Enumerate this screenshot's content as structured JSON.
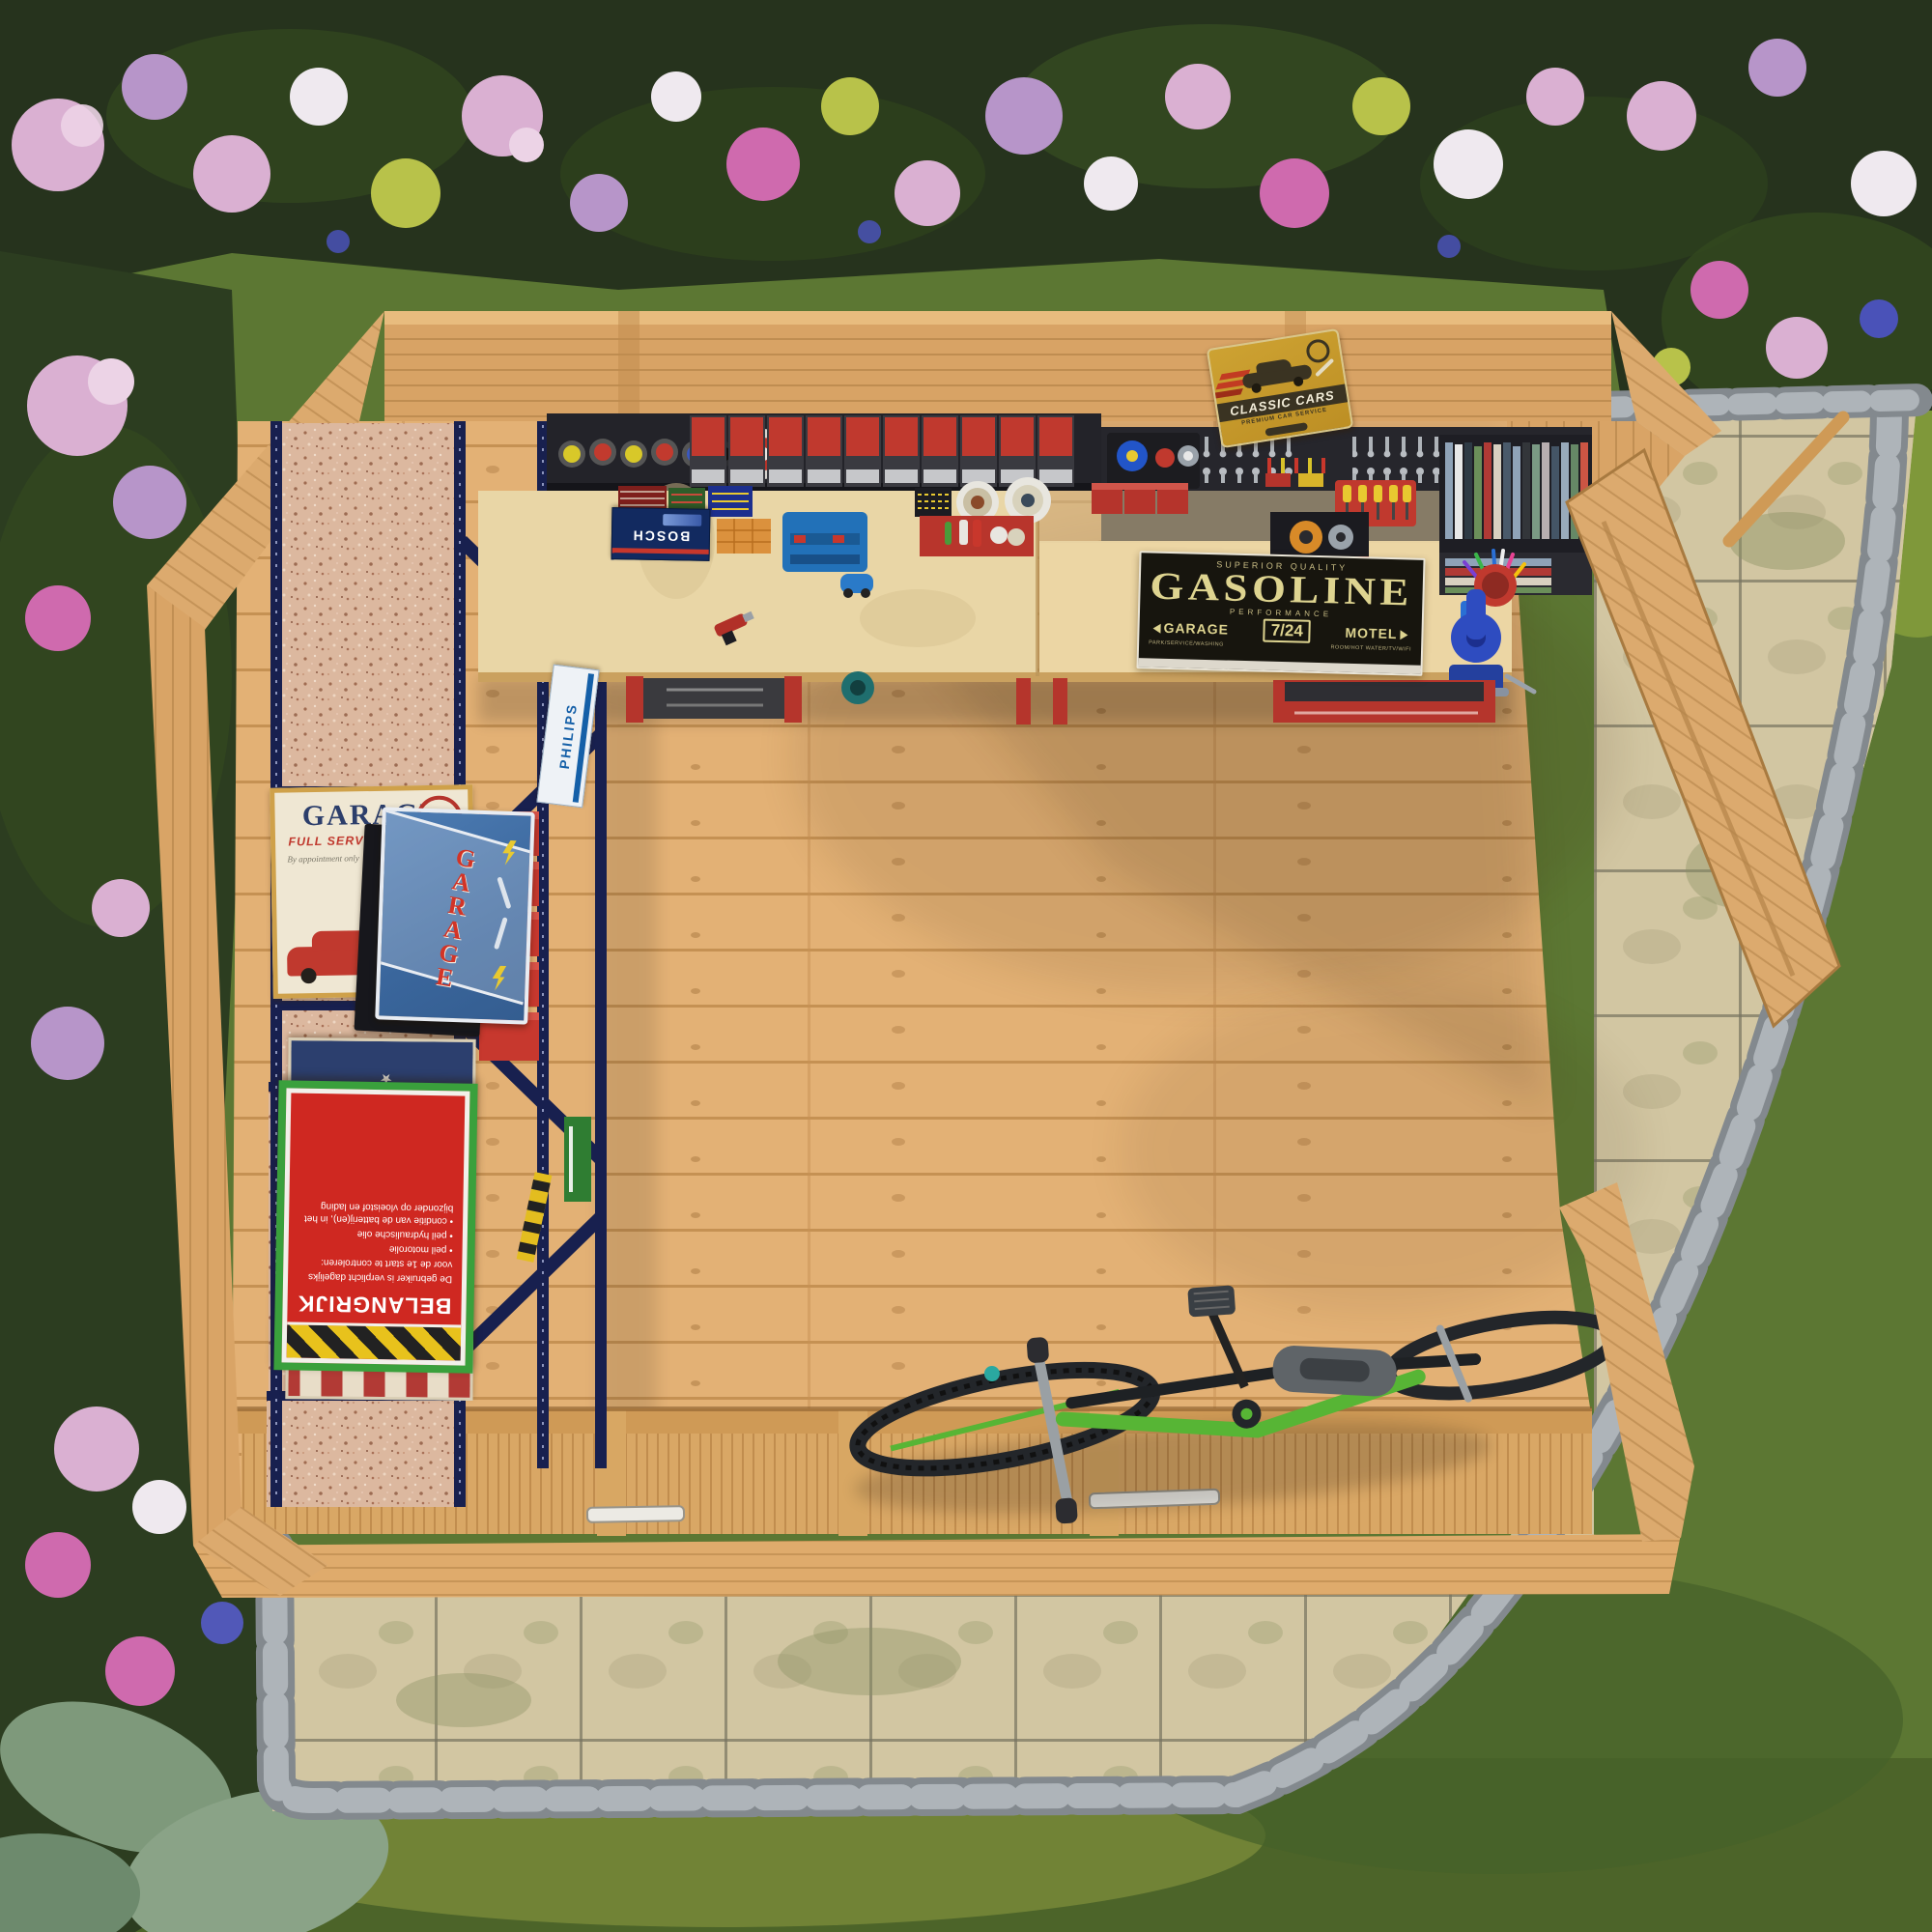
{
  "scene_title": "Top-down view of wooden garden workshop shed",
  "signs": {
    "gasoline": {
      "superior": "SUPERIOR QUALITY",
      "title": "GASOLINE",
      "performance": "PERFORMANCE",
      "left": "GARAGE",
      "center": "7/24",
      "right": "MOTEL",
      "left_sub": "PARK/SERVICE/WASHING",
      "right_sub": "ROOM/HOT WATER/TV/WIFI"
    },
    "classic_cars": {
      "title": "CLASSIC CARS",
      "subtitle": "PREMIUM CAR SERVICE"
    },
    "garage_poster": {
      "title": "GARAGE",
      "subtitle": "FULL SERVICE & REPAIR",
      "tagline": "By appointment only",
      "year": "1961",
      "badge": "★"
    },
    "garage_tin": {
      "title": "GARAGE"
    },
    "belangrijk": {
      "title": "BELANGRIJK",
      "line1": "De gebruiker is verplicht dagelijks",
      "line2": "voor de 1e start te controleren:",
      "bullets": [
        "• peil motorolie",
        "• peil hydraulische olie",
        "• conditie van de batterij(en), in het bijzonder op vloeistof en lading"
      ]
    },
    "motorcycle": {
      "script": "Garage",
      "word": "MOTORCYCLE",
      "duty": "MECHANIC ON DUTY",
      "parts": "REPAIR PARTS AND ACCESSORIES",
      "stars": "★ ★ ★ ★ ★ ★"
    }
  },
  "products": {
    "philips": "PHILIPS",
    "bosch": "BOSCH"
  },
  "colors": {
    "wood_wall": "#d8a365",
    "wood_floor": "#e2b173",
    "counter_plywood": "#e9d6a6",
    "cork_board": "#dcb89f",
    "rack_navy": "#18204f",
    "shelf_dark": "#232329",
    "bin_red": "#c0392e",
    "sign_black": "#17150e",
    "sign_cream": "#ded490",
    "classic_yellow": "#c59a2c",
    "belangrijk_red": "#cf2821",
    "belangrijk_green": "#3aa03c",
    "tin_blue": "#3a669c",
    "hedge_green": "#26331d",
    "grass_green": "#5c7733",
    "paving_beige": "#d2c6a2",
    "cobble_gray": "#8a9095",
    "bike_green": "#57b535"
  },
  "inventory": [
    "spray-cans",
    "storage-bins",
    "paint-tins",
    "tool-boxes",
    "bosch-case",
    "orange-parts-box",
    "blue-tool-case",
    "toy-car",
    "wrench-set",
    "hex-keys",
    "screwdriver-set",
    "manuals-books",
    "tape-rolls",
    "pen-cup",
    "marker",
    "bench-vise",
    "drill",
    "tool-cabinets",
    "grinder",
    "shelf-rack",
    "philips-tube-box",
    "red-storage-boxes",
    "green-toolbox",
    "hazard-level",
    "mountain-bike",
    "open-door",
    "door-stay",
    "paved-patio",
    "cobble-edging",
    "flower-bed",
    "hedge",
    "lawn"
  ]
}
